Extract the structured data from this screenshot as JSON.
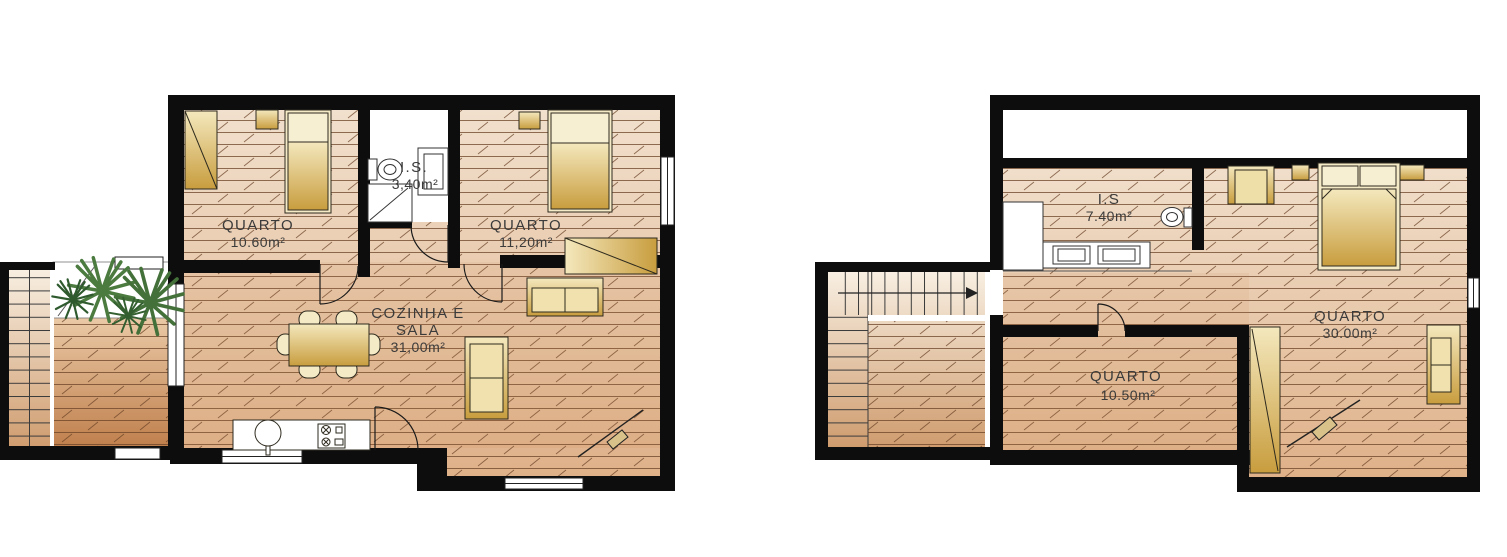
{
  "page": {
    "background": "#ffffff",
    "kind": "architectural floor plans"
  },
  "colors": {
    "wall": "#0d0d0d",
    "floor_light": "#f1e0cd",
    "floor_warm": "#dfb189",
    "deck_dark": "#bf7f4c",
    "plank_line": "#6b4226",
    "furniture_gold": "#c89d3e",
    "furniture_cream": "#f5eac6",
    "plant_green": "#4c7b40",
    "label_text": "#3b3b3b"
  },
  "left_plan": {
    "rooms": [
      {
        "label": "QUARTO",
        "area": "10.60m²"
      },
      {
        "label": "I.S.",
        "area": "3,40m²"
      },
      {
        "label": "QUARTO",
        "area": "11,20m²"
      },
      {
        "label": "COZINHA E",
        "label2": "SALA",
        "area": "31,00m²"
      }
    ]
  },
  "right_plan": {
    "rooms": [
      {
        "label": "I.S",
        "area": "7.40m²"
      },
      {
        "label": "QUARTO",
        "area": "30.00m²"
      },
      {
        "label": "QUARTO",
        "area": "10.50m²"
      }
    ]
  }
}
